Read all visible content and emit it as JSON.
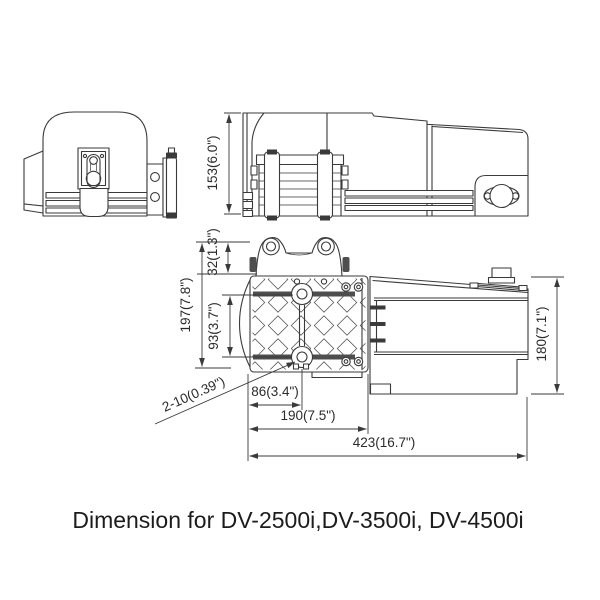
{
  "colors": {
    "background": "#ffffff",
    "line": "#3a3a3a",
    "text": "#2b2b2b",
    "caption": "#1c1c1c"
  },
  "caption": "Dimension for DV-2500i,DV-3500i, DV-4500i",
  "dimensions": {
    "side_height": "153(6.0\")",
    "mount_total_height": "197(7.8\")",
    "bracket_offset": "32(1.3\")",
    "hole_spacing_vertical": "93(3.7\")",
    "body_height": "180(7.1\")",
    "hole_note": "2-10(0.39\")",
    "hole_offset_horizontal": "86(3.4\")",
    "plate_width": "190(7.5\")",
    "overall_length": "423(16.7\")"
  }
}
